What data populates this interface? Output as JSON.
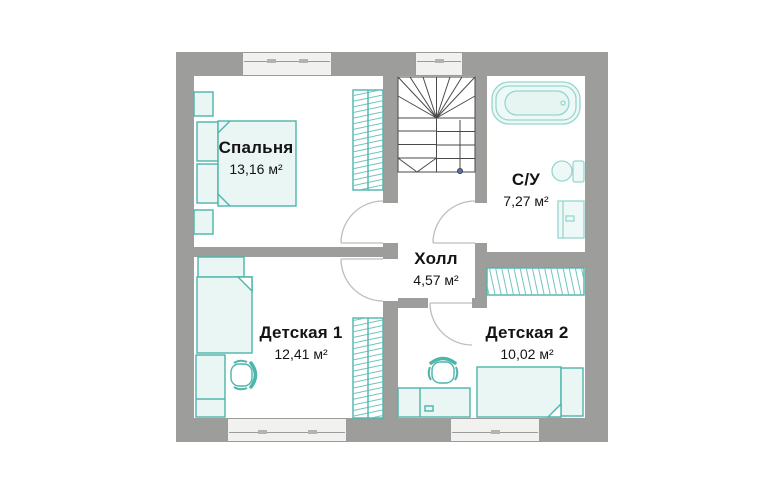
{
  "plan": {
    "rooms": [
      {
        "id": "bedroom",
        "name": "Спальня",
        "area": "13,16 м²"
      },
      {
        "id": "bathroom",
        "name": "С/У",
        "area": "7,27 м²"
      },
      {
        "id": "hall",
        "name": "Холл",
        "area": "4,57 м²"
      },
      {
        "id": "kids1",
        "name": "Детская 1",
        "area": "12,41 м²"
      },
      {
        "id": "kids2",
        "name": "Детская 2",
        "area": "10,02 м²"
      }
    ],
    "colors": {
      "wall": "#9d9d9c",
      "furniture_stroke": "#4db5ab",
      "furniture_fill": "#e9f6f4",
      "fixture_stroke": "#96d6cf",
      "fixture_fill": "#eef9f7",
      "hatch": "#6fc5bc",
      "stair_lines": "#4a4a4a",
      "door_arc": "#bdbdbd",
      "stair_post": "#5f6f9e"
    }
  }
}
